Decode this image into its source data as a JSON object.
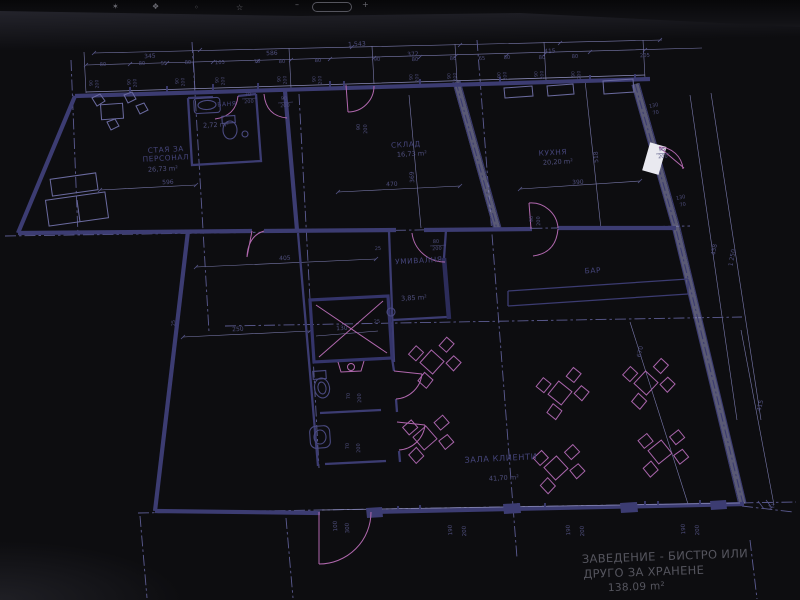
{
  "topbar": {
    "icons": [
      "faint-glyph-1",
      "faint-glyph-2",
      "faint-glyph-3",
      "star-icon",
      "zoom-out-icon",
      "zoom-indicator-pill",
      "zoom-in-icon"
    ]
  },
  "plan": {
    "rooms": [
      {
        "lines": [
          "СТАЯ ЗА",
          "ПЕРСОНАЛ"
        ],
        "area": "26,73 m²",
        "x": 166,
        "y": 152,
        "ax": 163,
        "ay": 171
      },
      {
        "lines": [
          "БАНЯ"
        ],
        "area": "2,72 m²",
        "x": 227,
        "y": 106,
        "ax": 216,
        "ay": 127,
        "s": 6
      },
      {
        "lines": [
          "СКЛАД"
        ],
        "area": "16,73 m²",
        "x": 406,
        "y": 147,
        "ax": 412,
        "ay": 156
      },
      {
        "lines": [
          "КУХНЯ"
        ],
        "area": "20,20 m²",
        "x": 553,
        "y": 155,
        "ax": 558,
        "ay": 164
      },
      {
        "lines": [
          "УМИВАЛНЯ"
        ],
        "area": "3,85 m²",
        "x": 419,
        "y": 263,
        "ax": 414,
        "ay": 300
      },
      {
        "lines": [
          "БАР"
        ],
        "area": "",
        "x": 593,
        "y": 273
      },
      {
        "lines": [
          "ЗАЛА КЛИЕНТИ"
        ],
        "area": "41,70 m²",
        "x": 501,
        "y": 461,
        "s": 8.2,
        "ax": 504,
        "ay": 480
      }
    ],
    "title": {
      "line1": "ЗАВЕДЕНИЕ - БИСТРО ИЛИ",
      "line2": "ДРУГО ЗА ХРАНЕНЕ",
      "area": "138.09 m²"
    },
    "window_labels": {
      "w": "90",
      "h": "200",
      "positions": [
        [
          95,
          83
        ],
        [
          133,
          82
        ],
        [
          181,
          81
        ],
        [
          221,
          80
        ],
        [
          283,
          79
        ],
        [
          318,
          79
        ],
        [
          415,
          77
        ],
        [
          453,
          76
        ],
        [
          503,
          75
        ],
        [
          540,
          74
        ],
        [
          577,
          74
        ]
      ]
    },
    "dims": [
      {
        "t": "1 543",
        "x": 357,
        "y": 46,
        "s": 6.2
      },
      {
        "t": "345",
        "x": 150,
        "y": 58,
        "s": 6
      },
      {
        "t": "586",
        "x": 272,
        "y": 55,
        "s": 6
      },
      {
        "t": "372",
        "x": 413,
        "y": 56,
        "s": 6
      },
      {
        "t": "415",
        "x": 550,
        "y": 53,
        "s": 6
      },
      {
        "t": "80",
        "x": 103,
        "y": 66,
        "s": 5.2
      },
      {
        "t": "80",
        "x": 142,
        "y": 65,
        "s": 5.2
      },
      {
        "t": "55",
        "x": 164,
        "y": 65,
        "s": 5.2
      },
      {
        "t": "80",
        "x": 188,
        "y": 64,
        "s": 5.2
      },
      {
        "t": "105",
        "x": 220,
        "y": 64,
        "s": 5.2
      },
      {
        "t": "78",
        "x": 257,
        "y": 63,
        "s": 5.2
      },
      {
        "t": "80",
        "x": 282,
        "y": 63,
        "s": 5.2
      },
      {
        "t": "80",
        "x": 318,
        "y": 62,
        "s": 5.2
      },
      {
        "t": "90",
        "x": 377,
        "y": 61,
        "s": 5.2
      },
      {
        "t": "80",
        "x": 415,
        "y": 61,
        "s": 5.2
      },
      {
        "t": "80",
        "x": 453,
        "y": 60,
        "s": 5.2
      },
      {
        "t": "65",
        "x": 482,
        "y": 60,
        "s": 5.2
      },
      {
        "t": "80",
        "x": 507,
        "y": 59,
        "s": 5.2
      },
      {
        "t": "80",
        "x": 542,
        "y": 59,
        "s": 5.2
      },
      {
        "t": "80",
        "x": 575,
        "y": 58,
        "s": 5.2
      },
      {
        "t": "205",
        "x": 645,
        "y": 57,
        "s": 5.2
      },
      {
        "t": "596",
        "x": 168,
        "y": 184
      },
      {
        "t": "470",
        "x": 392,
        "y": 186
      },
      {
        "t": "390",
        "x": 578,
        "y": 184
      },
      {
        "t": "405",
        "x": 285,
        "y": 260
      },
      {
        "t": "250",
        "x": 238,
        "y": 331
      },
      {
        "t": "130",
        "x": 342,
        "y": 330
      },
      {
        "t": "369",
        "x": 414,
        "y": 177,
        "r": -93
      },
      {
        "t": "518",
        "x": 598,
        "y": 157,
        "r": -93
      },
      {
        "t": "25",
        "x": 378,
        "y": 250,
        "s": 5
      },
      {
        "t": "25",
        "x": 377,
        "y": 323,
        "s": 5
      },
      {
        "t": "25",
        "x": 175,
        "y": 323,
        "r": -93,
        "s": 5
      },
      {
        "t": "80",
        "x": 436,
        "y": 243,
        "s": 5
      },
      {
        "t": "200",
        "x": 437,
        "y": 250,
        "s": 5
      },
      {
        "t": "70",
        "x": 248,
        "y": 96,
        "s": 5
      },
      {
        "t": "200",
        "x": 249,
        "y": 103,
        "s": 5
      },
      {
        "t": "90",
        "x": 284,
        "y": 100,
        "s": 5
      },
      {
        "t": "200",
        "x": 285,
        "y": 107,
        "s": 5
      },
      {
        "t": "95",
        "x": 662,
        "y": 151,
        "s": 5
      },
      {
        "t": "200",
        "x": 663,
        "y": 158,
        "s": 5
      },
      {
        "t": "90",
        "x": 360,
        "y": 127,
        "r": -93,
        "s": 5
      },
      {
        "t": "200",
        "x": 367,
        "y": 129,
        "r": -93,
        "s": 5
      },
      {
        "t": "90",
        "x": 533,
        "y": 219,
        "r": -93,
        "s": 5
      },
      {
        "t": "200",
        "x": 540,
        "y": 221,
        "r": -93,
        "s": 5
      },
      {
        "t": "70",
        "x": 350,
        "y": 396,
        "r": -93,
        "s": 5
      },
      {
        "t": "200",
        "x": 361,
        "y": 398,
        "r": -93,
        "s": 5
      },
      {
        "t": "70",
        "x": 349,
        "y": 446,
        "r": -93,
        "s": 5
      },
      {
        "t": "200",
        "x": 360,
        "y": 448,
        "r": -93,
        "s": 5
      },
      {
        "t": "100",
        "x": 337,
        "y": 526,
        "r": -93,
        "s": 5.5
      },
      {
        "t": "300",
        "x": 349,
        "y": 528,
        "r": -93,
        "s": 5.5
      },
      {
        "t": "190",
        "x": 452,
        "y": 530,
        "r": -93,
        "s": 5.5
      },
      {
        "t": "200",
        "x": 466,
        "y": 531,
        "r": -93,
        "s": 5.5
      },
      {
        "t": "190",
        "x": 570,
        "y": 530,
        "r": -93,
        "s": 5.5
      },
      {
        "t": "200",
        "x": 584,
        "y": 531,
        "r": -93,
        "s": 5.5
      },
      {
        "t": "190",
        "x": 685,
        "y": 529,
        "r": -93,
        "s": 5.5
      },
      {
        "t": "200",
        "x": 699,
        "y": 530,
        "r": -93,
        "s": 5.5
      },
      {
        "t": "130",
        "x": 654,
        "y": 107,
        "r": -12,
        "s": 5
      },
      {
        "t": "70",
        "x": 656,
        "y": 114,
        "r": -12,
        "s": 5
      },
      {
        "t": "130",
        "x": 681,
        "y": 199,
        "r": -12,
        "s": 5
      },
      {
        "t": "70",
        "x": 683,
        "y": 206,
        "r": -12,
        "s": 5
      },
      {
        "t": "438",
        "x": 716,
        "y": 250,
        "r": -80
      },
      {
        "t": "1 250",
        "x": 734,
        "y": 258,
        "r": -80
      },
      {
        "t": "415",
        "x": 762,
        "y": 406,
        "r": -76
      },
      {
        "t": "670",
        "x": 642,
        "y": 352,
        "r": -78
      },
      {
        "t": "12",
        "x": 772,
        "y": 508,
        "r": -20,
        "s": 5
      }
    ]
  },
  "colors": {
    "ink": "#3c3c72",
    "thin_line": "#7b7bae",
    "accent_pink": "#b168ae",
    "dim_text": "#4f4f7d",
    "paper": "#e9e9f0",
    "topbar": "#0d0d10"
  }
}
